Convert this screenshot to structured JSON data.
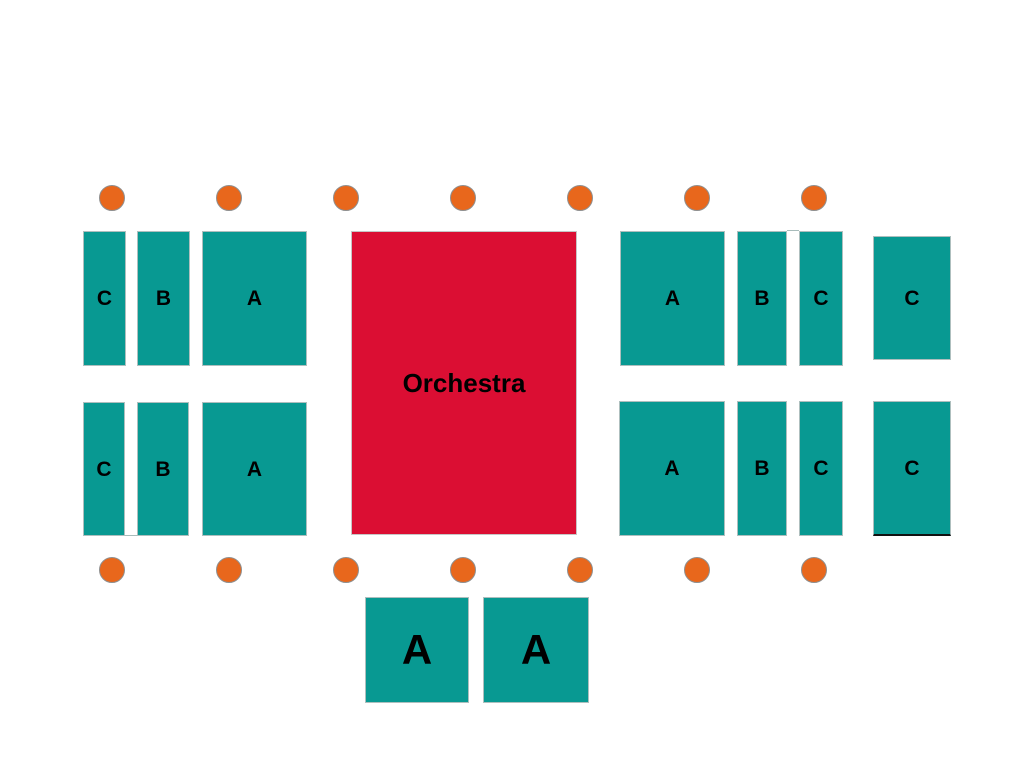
{
  "map": {
    "colors": {
      "page_bg": "#ffffff",
      "section_fill": "#089992",
      "section_border": "#aebfbe",
      "stage_fill": "#DB0E33",
      "stage_border": "#c6c6c6",
      "dot_fill": "#E8671C",
      "dot_border": "#8f8f8f",
      "label_color": "#000000",
      "gap_line": "#a8bcbb",
      "accent_line": "#111111"
    },
    "stage": {
      "id": "orchestra",
      "label": "Orchestra",
      "x": 351,
      "y": 231,
      "w": 226,
      "h": 304,
      "font_size": 26
    },
    "sections": [
      {
        "id": "left-upper-c",
        "label": "C",
        "x": 83,
        "y": 231,
        "w": 43,
        "h": 135,
        "font_size": 21
      },
      {
        "id": "left-upper-b",
        "label": "B",
        "x": 137,
        "y": 231,
        "w": 53,
        "h": 135,
        "font_size": 21
      },
      {
        "id": "left-upper-a",
        "label": "A",
        "x": 202,
        "y": 231,
        "w": 105,
        "h": 135,
        "font_size": 21
      },
      {
        "id": "left-lower-c",
        "label": "C",
        "x": 83,
        "y": 402,
        "w": 42,
        "h": 134,
        "font_size": 21
      },
      {
        "id": "left-lower-b",
        "label": "B",
        "x": 137,
        "y": 402,
        "w": 52,
        "h": 134,
        "font_size": 21
      },
      {
        "id": "left-lower-a",
        "label": "A",
        "x": 202,
        "y": 402,
        "w": 105,
        "h": 134,
        "font_size": 21
      },
      {
        "id": "right-upper-a",
        "label": "A",
        "x": 620,
        "y": 231,
        "w": 105,
        "h": 135,
        "font_size": 21
      },
      {
        "id": "right-upper-b",
        "label": "B",
        "x": 737,
        "y": 231,
        "w": 50,
        "h": 135,
        "font_size": 21
      },
      {
        "id": "right-upper-c",
        "label": "C",
        "x": 799,
        "y": 231,
        "w": 44,
        "h": 135,
        "font_size": 21
      },
      {
        "id": "far-right-upper-c",
        "label": "C",
        "x": 873,
        "y": 236,
        "w": 78,
        "h": 124,
        "font_size": 21
      },
      {
        "id": "right-lower-a",
        "label": "A",
        "x": 619,
        "y": 401,
        "w": 106,
        "h": 135,
        "font_size": 21
      },
      {
        "id": "right-lower-b",
        "label": "B",
        "x": 737,
        "y": 401,
        "w": 50,
        "h": 135,
        "font_size": 21
      },
      {
        "id": "right-lower-c",
        "label": "C",
        "x": 799,
        "y": 401,
        "w": 44,
        "h": 135,
        "font_size": 21
      },
      {
        "id": "far-right-lower-c",
        "label": "C",
        "x": 873,
        "y": 401,
        "w": 78,
        "h": 135,
        "font_size": 21,
        "bottom_line": true
      },
      {
        "id": "bottom-left-a",
        "label": "A",
        "x": 365,
        "y": 597,
        "w": 104,
        "h": 106,
        "font_size": 42
      },
      {
        "id": "bottom-right-a",
        "label": "A",
        "x": 483,
        "y": 597,
        "w": 106,
        "h": 106,
        "font_size": 42
      }
    ],
    "dots": [
      {
        "x": 112,
        "y": 198
      },
      {
        "x": 229,
        "y": 198
      },
      {
        "x": 346,
        "y": 198
      },
      {
        "x": 463,
        "y": 198
      },
      {
        "x": 580,
        "y": 198
      },
      {
        "x": 697,
        "y": 198
      },
      {
        "x": 814,
        "y": 198
      },
      {
        "x": 112,
        "y": 570
      },
      {
        "x": 229,
        "y": 570
      },
      {
        "x": 346,
        "y": 570
      },
      {
        "x": 463,
        "y": 570
      },
      {
        "x": 580,
        "y": 570
      },
      {
        "x": 697,
        "y": 570
      },
      {
        "x": 814,
        "y": 570
      }
    ],
    "dot_diameter": 26,
    "detail_lines": [
      {
        "id": "right-upper-bc-gap-top",
        "x": 787,
        "y": 230,
        "w": 12,
        "h": 1,
        "color_key": "gap_line"
      },
      {
        "id": "left-lower-cb-gap-bottom",
        "x": 125,
        "y": 535,
        "w": 12,
        "h": 1,
        "color_key": "gap_line"
      }
    ]
  }
}
